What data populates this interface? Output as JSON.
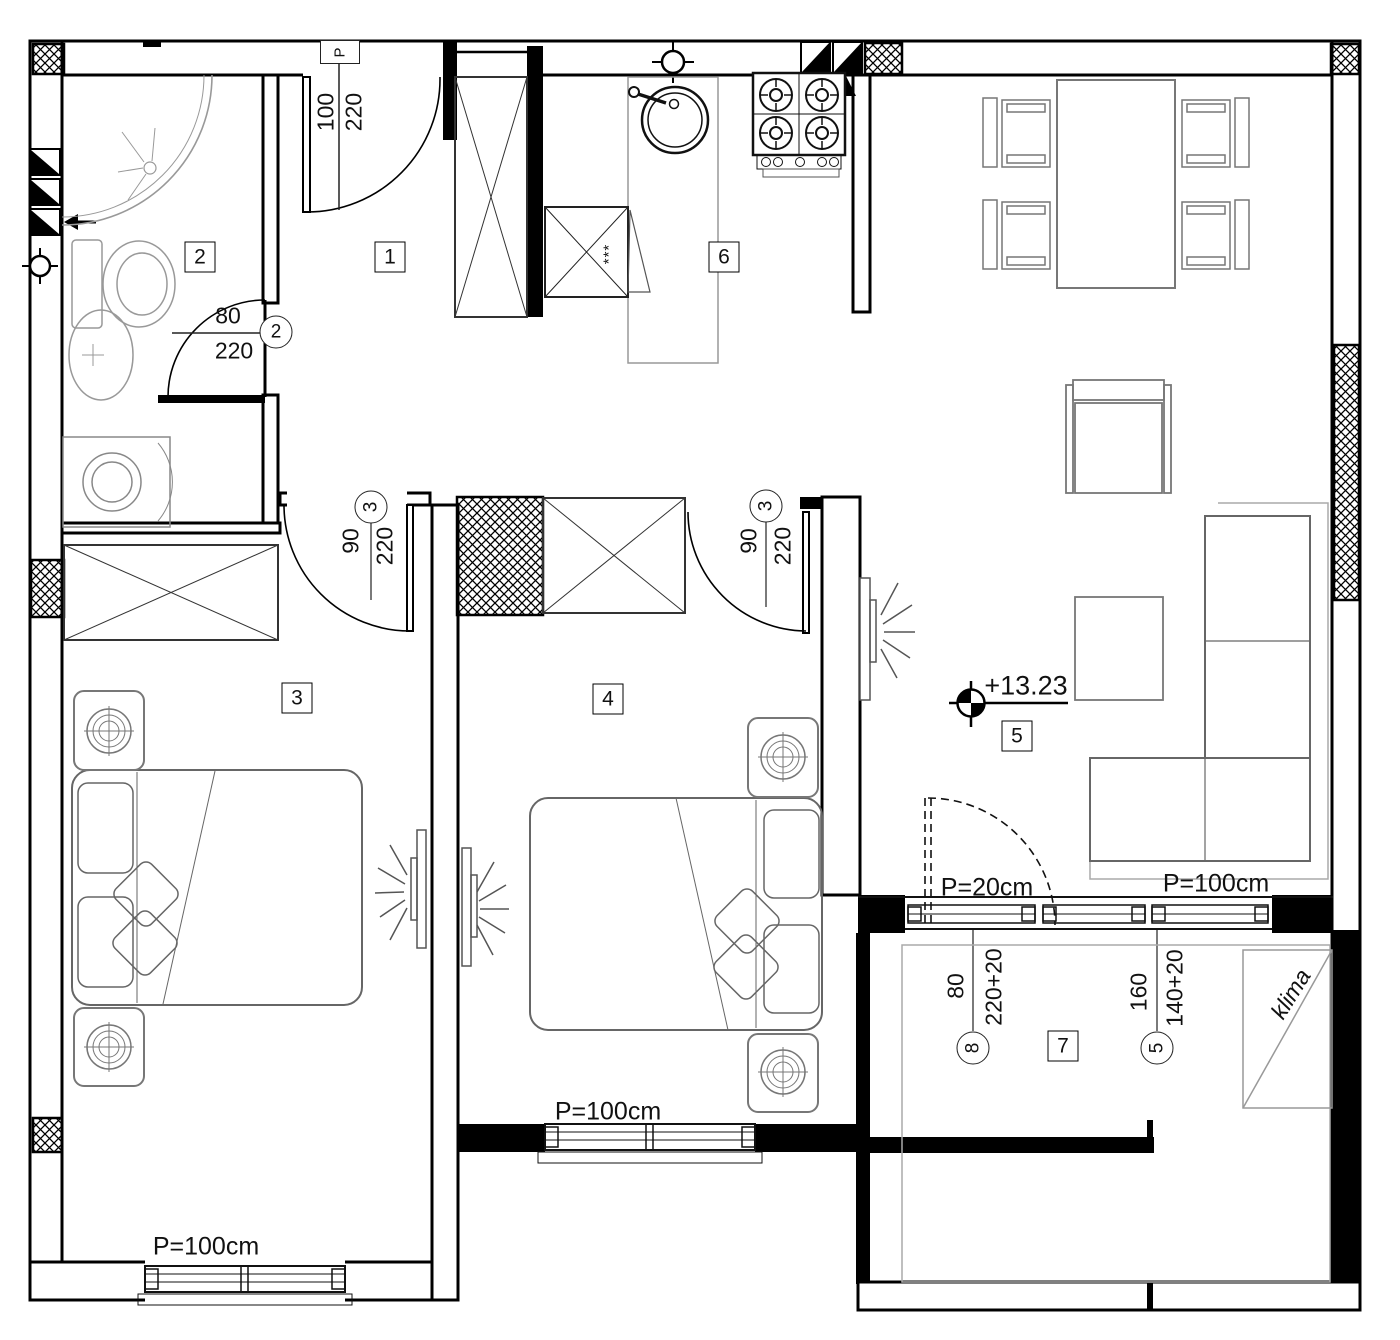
{
  "rooms": [
    "1",
    "2",
    "3",
    "4",
    "5",
    "6",
    "7"
  ],
  "door_labels": {
    "entry": {
      "box": "P",
      "num": "100",
      "den": "220"
    },
    "bath": {
      "num": "80",
      "den": "220",
      "mark": "2"
    },
    "bed3": {
      "num": "90",
      "den": "220",
      "mark": "3"
    },
    "bed4": {
      "num": "90",
      "den": "220",
      "mark": "3"
    },
    "balcony_door": {
      "num": "80",
      "den": "220+20",
      "mark": "8"
    },
    "living_window": {
      "num": "160",
      "den": "140+20",
      "mark": "5"
    }
  },
  "window_labels": {
    "bed3": "P=100cm",
    "bed4": "P=100cm",
    "balcony": "P=20cm",
    "terrace": "P=100cm"
  },
  "elevation": "+13.23",
  "ac_label": "klima",
  "appliance_stars": "***",
  "colors": {
    "wall": "#000000",
    "furniture": "#777777",
    "fixture": "#999999"
  }
}
